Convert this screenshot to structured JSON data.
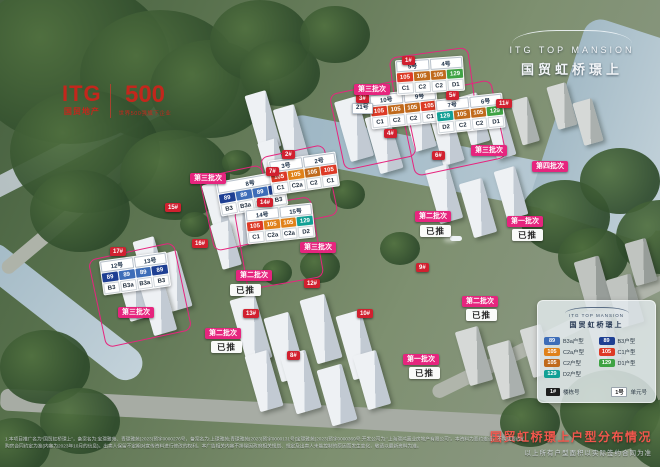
{
  "brand": {
    "itg": "ITG",
    "itg_sub": "国贸地产",
    "five_hundred": "500",
    "five_hundred_sub": "世界500强旗下企业"
  },
  "project": {
    "logo_en": "ITG TOP MANSION",
    "logo_cn": "国贸虹桥璟上"
  },
  "map": {
    "launched_label": "已推",
    "launched_positions": [
      {
        "x": 420,
        "y": 225
      },
      {
        "x": 512,
        "y": 229
      },
      {
        "x": 466,
        "y": 309
      },
      {
        "x": 230,
        "y": 284
      },
      {
        "x": 211,
        "y": 341
      },
      {
        "x": 409,
        "y": 367
      }
    ],
    "batch_badges": [
      {
        "t": "第三批次",
        "x": 118,
        "y": 307
      },
      {
        "t": "第三批次",
        "x": 190,
        "y": 173
      },
      {
        "t": "第三批次",
        "x": 300,
        "y": 242
      },
      {
        "t": "第三批次",
        "x": 354,
        "y": 84
      },
      {
        "t": "第三批次",
        "x": 471,
        "y": 145
      },
      {
        "t": "第四批次",
        "x": 532,
        "y": 161
      },
      {
        "t": "第二批次",
        "x": 415,
        "y": 211
      },
      {
        "t": "第二批次",
        "x": 236,
        "y": 270
      },
      {
        "t": "第二批次",
        "x": 205,
        "y": 328
      },
      {
        "t": "第二批次",
        "x": 462,
        "y": 296
      },
      {
        "t": "第一批次",
        "x": 507,
        "y": 216
      },
      {
        "t": "第一批次",
        "x": 403,
        "y": 354
      }
    ],
    "building_badges": [
      {
        "t": "17#",
        "x": 110,
        "y": 247
      },
      {
        "t": "15#",
        "x": 165,
        "y": 203
      },
      {
        "t": "16#",
        "x": 192,
        "y": 239
      },
      {
        "t": "7#",
        "x": 266,
        "y": 167
      },
      {
        "t": "2#",
        "x": 282,
        "y": 150
      },
      {
        "t": "14#",
        "x": 257,
        "y": 198
      },
      {
        "t": "3#",
        "x": 356,
        "y": 94
      },
      {
        "t": "4#",
        "x": 384,
        "y": 129
      },
      {
        "t": "1#",
        "x": 402,
        "y": 56
      },
      {
        "t": "5#",
        "x": 446,
        "y": 91
      },
      {
        "t": "6#",
        "x": 432,
        "y": 151
      },
      {
        "t": "11#",
        "x": 496,
        "y": 99
      },
      {
        "t": "9#",
        "x": 416,
        "y": 263
      },
      {
        "t": "12#",
        "x": 304,
        "y": 279
      },
      {
        "t": "13#",
        "x": 243,
        "y": 309
      },
      {
        "t": "10#",
        "x": 357,
        "y": 309
      },
      {
        "t": "8#",
        "x": 287,
        "y": 351
      }
    ],
    "unit_badges": [
      {
        "t": "21号",
        "x": 352,
        "y": 103
      }
    ],
    "clusters": [
      {
        "id": "c1",
        "x": 101,
        "y": 256,
        "rot": -8,
        "units": [
          "12号",
          "13号"
        ],
        "labels": [
          "B3",
          "B3a",
          "B3a",
          "B3"
        ]
      },
      {
        "id": "c2",
        "x": 218,
        "y": 176,
        "rot": -10,
        "units": [
          "8号"
        ],
        "labels": [
          "B3",
          "B3a",
          "B3a",
          "B3"
        ]
      },
      {
        "id": "c3",
        "x": 270,
        "y": 156,
        "rot": -8,
        "units": [
          "3号",
          "2号"
        ],
        "labels": [
          "C1",
          "C2a",
          "C2",
          "C1"
        ]
      },
      {
        "id": "c4",
        "x": 246,
        "y": 206,
        "rot": -6,
        "units": [
          "14号",
          "15号"
        ],
        "labels": [
          "C1",
          "C2a",
          "C2a",
          "D2"
        ]
      },
      {
        "id": "c5",
        "x": 370,
        "y": 91,
        "rot": -6,
        "units": [
          "10号",
          "9号"
        ],
        "labels": [
          "C1",
          "C2",
          "C2",
          "C1"
        ]
      },
      {
        "id": "c6",
        "x": 436,
        "y": 96,
        "rot": -6,
        "units": [
          "7号",
          "6号"
        ],
        "labels": [
          "D2",
          "C2",
          "C2",
          "D1"
        ]
      },
      {
        "id": "c7",
        "x": 396,
        "y": 58,
        "rot": -4,
        "units": [
          "5号",
          "4号"
        ],
        "labels": [
          "C1",
          "C2",
          "C2",
          "D1"
        ]
      }
    ],
    "type_map": {
      "B3": {
        "area": "89",
        "color": "#1e3f93"
      },
      "B3a": {
        "area": "89",
        "color": "#3d6db8"
      },
      "C1": {
        "area": "105",
        "color": "#dd3a26"
      },
      "C2": {
        "area": "105",
        "color": "#c06a1c"
      },
      "C2a": {
        "area": "105",
        "color": "#e08119"
      },
      "D1": {
        "area": "129",
        "color": "#3fa344"
      },
      "D2": {
        "area": "129",
        "color": "#12a095"
      }
    }
  },
  "legend": {
    "logo_en": "ITG TOP MANSION",
    "logo_cn": "国贸虹桥璟上",
    "items": [
      {
        "area": "89",
        "type": "B3a户型",
        "color": "#3d6db8"
      },
      {
        "area": "89",
        "type": "B3户型",
        "color": "#1e3f93"
      },
      {
        "area": "105",
        "type": "C2a户型",
        "color": "#e08119"
      },
      {
        "area": "105",
        "type": "C1户型",
        "color": "#dd3a26"
      },
      {
        "area": "105",
        "type": "C2户型",
        "color": "#c06a1c"
      },
      {
        "area": "129",
        "type": "D1户型",
        "color": "#3fa344"
      },
      {
        "area": "129",
        "type": "D2户型",
        "color": "#12a095"
      }
    ],
    "keys": [
      {
        "badge": "1#",
        "label": "楼栋号",
        "style": "dark"
      },
      {
        "badge": "1号",
        "label": "单元号",
        "style": "light"
      }
    ]
  },
  "footer": {
    "title": "国贸虹桥璟上户型分布情况",
    "subtitle": "以上所有户型面积以实际签约合同为准",
    "disclaimer_line1": "1.本项目推广名为“国贸虹桥璟上”，备案名为:宝璟雅苑、青璟雅苑(2023)预字0000276号，备案名为:上璟雅苑;青璟雅苑(2023)预字0000131号|宝璟雅苑(2023)预字0000369号;开发公司为:“上海璟鸿置业房地产有限公司”。本资料为要约邀请，不构成要约或承诺，双方权利义务以",
    "disclaimer_line2": "购房合同约定为准(内容为2023年10月的信息)。出卖人保留不定期对宣传资料进行修改的权利。本广告相关内容不排除因政府相关规划、规定及出卖人未能控制的原因而发生变化，敬请以最新资料为准。"
  }
}
